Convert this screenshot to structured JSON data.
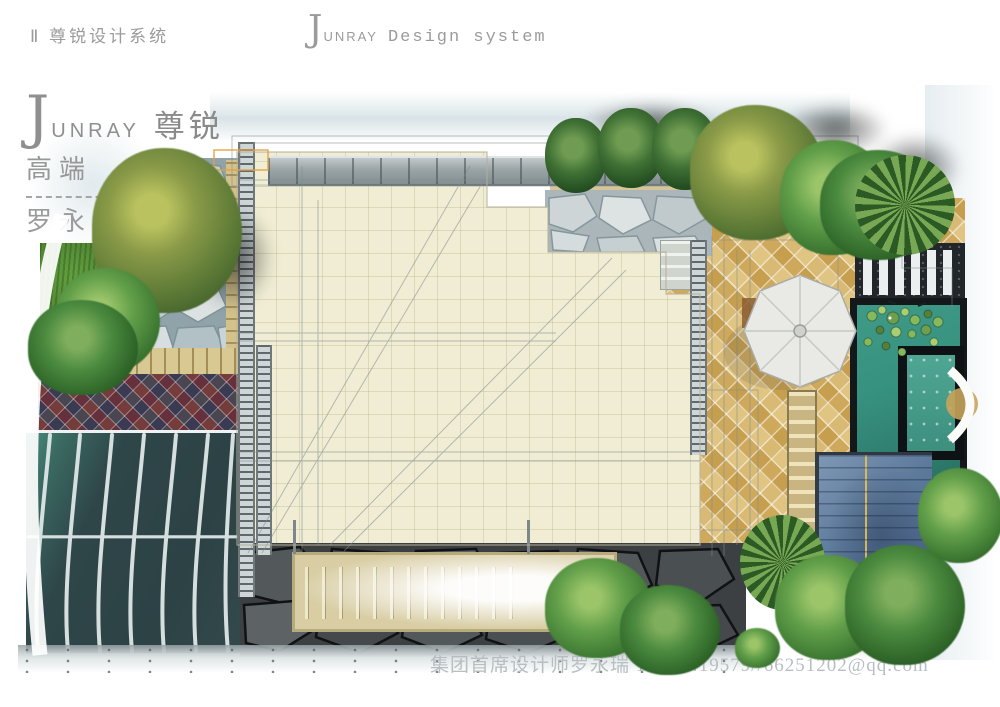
{
  "header": {
    "system_label": "Ⅱ 尊锐设计系统",
    "brand": {
      "initial": "J",
      "name": "UNRAY",
      "tagline": "Design system"
    }
  },
  "watermark": {
    "initial": "J",
    "name": "UNRAY",
    "cn": "尊锐",
    "line2": "高端",
    "line3": "罗永"
  },
  "footer": {
    "credit": "集团首席设计师罗永瑞 13708419579//66251202@qq.com"
  },
  "colors": {
    "heading_gray": "#9b9b9b",
    "watermark_gray": "#b7bec2",
    "floor_cream": "#f0edd4",
    "tile_gold": "#d7b569",
    "pool_teal": "#37917f",
    "pool_teal_dark": "#2a7264",
    "roof_blue": "#5d7a9c",
    "canopy_glass": "#2f4649",
    "stone_dark": "#3c4043",
    "lawn_green": "#4c7f2f",
    "beam_gray": "#9aa4a7"
  },
  "plan": {
    "regions": [
      "lawn-garden",
      "flagstone-patio",
      "mosaic-tile-band",
      "glass-canopy",
      "main-floor",
      "flagstone-terrace",
      "gold-tile-patio",
      "parasol",
      "lily-pond",
      "spa-pool",
      "slat-bench-pergola",
      "tile-roof-pavilion",
      "sunken-stair",
      "stone-paving-strip"
    ]
  }
}
